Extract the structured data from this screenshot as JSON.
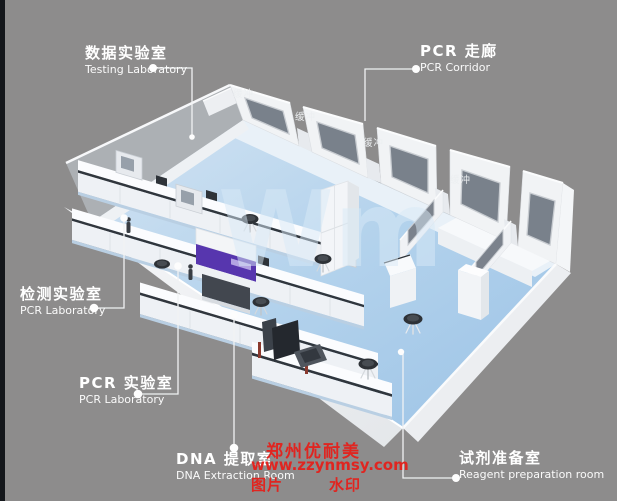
{
  "room_labels": {
    "testing_lab": {
      "zh": "数据实验室",
      "en": "Testing Laboratory"
    },
    "pcr_corridor": {
      "zh": "PCR 走廊",
      "en": "PCR Corridor"
    },
    "detection_lab": {
      "zh": "检测实验室",
      "en": "PCR Laboratory"
    },
    "pcr_lab": {
      "zh": "PCR 实验室",
      "en": "PCR Laboratory"
    },
    "dna_extraction": {
      "zh": "DNA 提取室",
      "en": "DNA Extraction Room"
    },
    "reagent_prep": {
      "zh": "试剂准备室",
      "en": "Reagent preparation room"
    }
  },
  "buffer_labels": [
    "缓冲",
    "缓冲",
    "缓冲",
    "缓冲"
  ],
  "watermark": {
    "company": "郑州优耐美",
    "website": "www.zzynmsy.com",
    "label_left": "图片",
    "label_right": "水印",
    "color": "#e02520"
  },
  "floor_watermark": "Wm",
  "colors": {
    "background": "#8d8c8c",
    "edge_strip": "#14171b",
    "floor_blue": "#aecfe9",
    "wall_white": "#f2f4f6",
    "window_gray": "#7b828c",
    "cabinet_purple": "#5736ae",
    "label_text": "#ffffff",
    "watermark_red": "#e02520"
  }
}
